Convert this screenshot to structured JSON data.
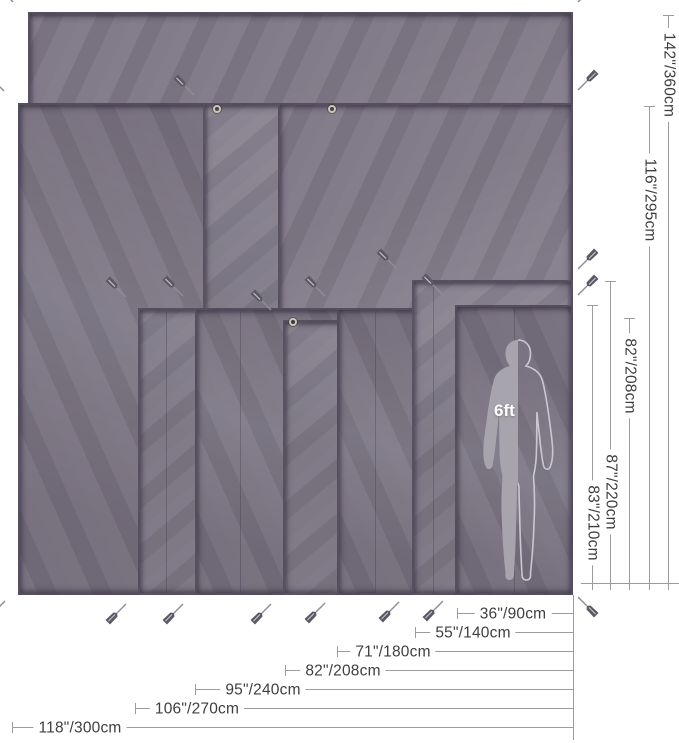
{
  "figure": {
    "title": "tarp-size-comparison-diagram",
    "person_label": "6ft",
    "colors": {
      "tarp_base": "#7f7887",
      "tarp_edge": "#484152",
      "measure_line": "#9c9c9c",
      "label_text": "#3e3e3e",
      "silhouette_fill": "#a8a4ae",
      "silhouette_outline": "#cbc7d1",
      "grommet": "#cdc7b2",
      "background": "#ffffff"
    },
    "canvas": {
      "width": 679,
      "height": 743
    },
    "tarp_right_edge": 573,
    "tarp_bottom_edge": 595,
    "height_measurements": [
      {
        "label": "142\"/360cm",
        "x": 668,
        "y1": 15,
        "y2": 590,
        "label_y": 75
      },
      {
        "label": "116\"/295cm",
        "x": 649,
        "y1": 106,
        "y2": 590,
        "label_y": 200
      },
      {
        "label": "82\"/208cm",
        "x": 629,
        "y1": 318,
        "y2": 590,
        "label_y": 376
      },
      {
        "label": "87\"/220cm",
        "x": 610,
        "y1": 281,
        "y2": 590,
        "label_y": 492
      },
      {
        "label": "83\"/210cm",
        "x": 592,
        "y1": 305,
        "y2": 590,
        "label_y": 523
      }
    ],
    "width_measurements": [
      {
        "label": "36\"/90cm",
        "y": 613,
        "x1": 457,
        "label_x": 513
      },
      {
        "label": "55\"/140cm",
        "y": 632,
        "x1": 415,
        "label_x": 473
      },
      {
        "label": "71\"/180cm",
        "y": 651,
        "x1": 337,
        "label_x": 393
      },
      {
        "label": "82\"/208cm",
        "y": 670,
        "x1": 285,
        "label_x": 343
      },
      {
        "label": "95\"/240cm",
        "y": 689,
        "x1": 195,
        "label_x": 263
      },
      {
        "label": "106\"/270cm",
        "y": 708,
        "x1": 135,
        "label_x": 197
      },
      {
        "label": "118\"/300cm",
        "y": 727,
        "x1": 12,
        "label_x": 80
      }
    ],
    "guides": {
      "vertical": {
        "x": 573,
        "y1": 595,
        "y2": 740
      },
      "horizontal": {
        "y": 583,
        "x1": 581,
        "x2": 679
      }
    },
    "tarps": [
      {
        "l": 28,
        "t": 12,
        "v": 0
      },
      {
        "l": 18,
        "t": 103,
        "v": 1
      },
      {
        "l": 203,
        "t": 103,
        "v": 2
      },
      {
        "l": 278,
        "t": 103,
        "v": 0
      },
      {
        "l": 138,
        "t": 308,
        "v": 2
      },
      {
        "l": 195,
        "t": 308,
        "v": 1
      },
      {
        "l": 283,
        "t": 320,
        "v": 2
      },
      {
        "l": 337,
        "t": 308,
        "v": 1
      },
      {
        "l": 412,
        "t": 280,
        "v": 2
      },
      {
        "l": 455,
        "t": 305,
        "v": 1
      }
    ],
    "seams": [
      {
        "x": 166,
        "y1": 312,
        "y2": 593
      },
      {
        "x": 240,
        "y1": 312,
        "y2": 593
      },
      {
        "x": 375,
        "y1": 312,
        "y2": 593
      },
      {
        "x": 433,
        "y1": 284,
        "y2": 593
      },
      {
        "x": 514,
        "y1": 309,
        "y2": 593
      }
    ],
    "stakes": [
      {
        "x": 14,
        "y": 3,
        "dir": "ul"
      },
      {
        "x": 577,
        "y": 3,
        "dir": "ur"
      },
      {
        "x": 5,
        "y": 92,
        "dir": "ul"
      },
      {
        "x": 577,
        "y": 91,
        "dir": "ur"
      },
      {
        "x": 195,
        "y": 96,
        "dir": "ul"
      },
      {
        "x": 127,
        "y": 298,
        "dir": "ul"
      },
      {
        "x": 184,
        "y": 297,
        "dir": "ul"
      },
      {
        "x": 272,
        "y": 311,
        "dir": "ul"
      },
      {
        "x": 326,
        "y": 297,
        "dir": "ul"
      },
      {
        "x": 398,
        "y": 270,
        "dir": "ul"
      },
      {
        "x": 443,
        "y": 295,
        "dir": "ul"
      },
      {
        "x": 577,
        "y": 270,
        "dir": "ur"
      },
      {
        "x": 577,
        "y": 296,
        "dir": "ur"
      },
      {
        "x": 6,
        "y": 600,
        "dir": "dl"
      },
      {
        "x": 127,
        "y": 603,
        "dir": "dl"
      },
      {
        "x": 184,
        "y": 603,
        "dir": "dl"
      },
      {
        "x": 272,
        "y": 603,
        "dir": "dl"
      },
      {
        "x": 326,
        "y": 602,
        "dir": "dl"
      },
      {
        "x": 400,
        "y": 601,
        "dir": "dl"
      },
      {
        "x": 444,
        "y": 600,
        "dir": "dl"
      },
      {
        "x": 577,
        "y": 596,
        "dir": "dr"
      }
    ],
    "grommets": [
      {
        "x": 217,
        "y": 109
      },
      {
        "x": 332,
        "y": 109
      },
      {
        "x": 293,
        "y": 322
      }
    ],
    "silhouette": {
      "left": 477,
      "top": 339,
      "width": 82,
      "height": 244
    },
    "person_label_pos": {
      "x": 494,
      "y": 401
    }
  }
}
